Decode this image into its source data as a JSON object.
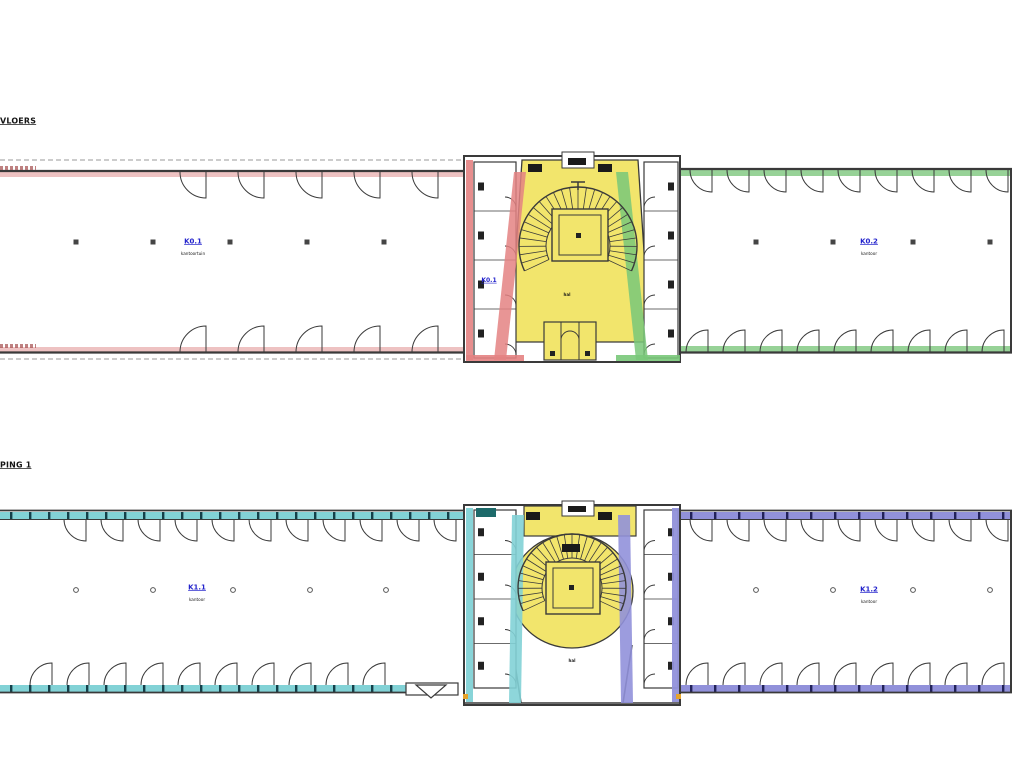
{
  "titles": {
    "ground": "VLOERS",
    "first": "PING 1"
  },
  "ground": {
    "left_room": {
      "code": "K0.1",
      "type": "kantoortuin"
    },
    "right_room": {
      "code": "K0.2",
      "type": "kantoor"
    },
    "core_room": {
      "code": "K0.1"
    },
    "hall": "hal"
  },
  "first": {
    "left_room": {
      "code": "K1.1",
      "type": "kantoor"
    },
    "right_room": {
      "code": "K1.2",
      "type": "kantoor"
    },
    "hall": "hal"
  },
  "colors": {
    "line": "#3a3a3a",
    "label_blue": "#2323cc",
    "yellow": "#f2e56c",
    "red": "#e48282",
    "pink_strip": "#eec2c2",
    "green": "#79c879",
    "green_strip": "#97d297",
    "cyan": "#82d2d6",
    "purple": "#9191da",
    "orange": "#e6a32a"
  }
}
